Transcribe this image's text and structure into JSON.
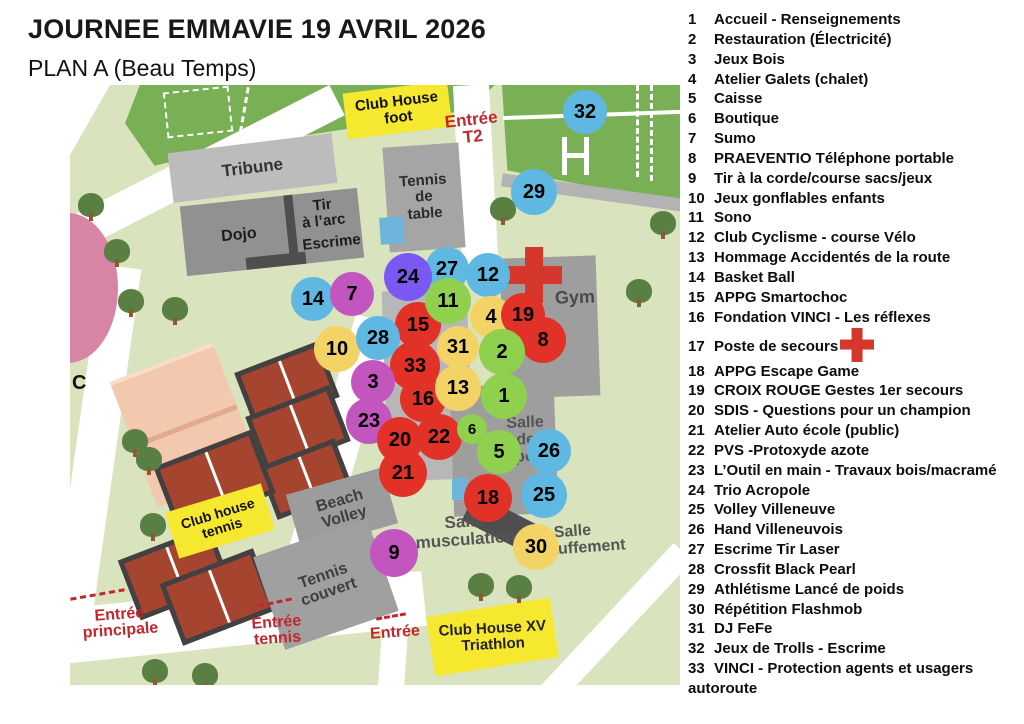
{
  "title": "JOURNEE EMMAVIE 19 AVRIL 2026",
  "subtitle": "PLAN A (Beau Temps)",
  "legend": {
    "items": [
      {
        "num": "1",
        "label": "Accueil - Renseignements"
      },
      {
        "num": "2",
        "label": "Restauration (Électricité)"
      },
      {
        "num": "3",
        "label": "Jeux Bois"
      },
      {
        "num": "4",
        "label": "Atelier Galets (chalet)"
      },
      {
        "num": "5",
        "label": "Caisse"
      },
      {
        "num": "6",
        "label": "Boutique"
      },
      {
        "num": "7",
        "label": "Sumo"
      },
      {
        "num": "8",
        "label": "PRAEVENTIO Téléphone portable"
      },
      {
        "num": "9",
        "label": "Tir à la corde/course sacs/jeux"
      },
      {
        "num": "10",
        "label": "Jeux gonflables enfants"
      },
      {
        "num": "11",
        "label": "Sono"
      },
      {
        "num": "12",
        "label": "Club Cyclisme  - course Vélo"
      },
      {
        "num": "13",
        "label": "Hommage Accidentés de la route"
      },
      {
        "num": "14",
        "label": "Basket Ball"
      },
      {
        "num": "15",
        "label": "APPG Smartochoc"
      },
      {
        "num": "16",
        "label": "Fondation  VINCI - Les réflexes"
      },
      {
        "num": "17",
        "label": "Poste de secours",
        "cross": true
      },
      {
        "num": "18",
        "label": "APPG Escape Game"
      },
      {
        "num": "19",
        "label": "CROIX ROUGE Gestes 1er secours"
      },
      {
        "num": "20",
        "label": "SDIS - Questions pour un champion"
      },
      {
        "num": "21",
        "label": "Atelier Auto école (public)"
      },
      {
        "num": "22",
        "label": "PVS -Protoxyde azote"
      },
      {
        "num": "23",
        "label": "L’Outil en main - Travaux bois/macramé"
      },
      {
        "num": "24",
        "label": "Trio Acropole"
      },
      {
        "num": "25",
        "label": "Volley Villeneuve"
      },
      {
        "num": "26",
        "label": "Hand Villeneuvois"
      },
      {
        "num": "27",
        "label": "Escrime  Tir Laser"
      },
      {
        "num": "28",
        "label": "Crossfit Black Pearl"
      },
      {
        "num": "29",
        "label": "Athlétisme Lancé de poids"
      },
      {
        "num": "30",
        "label": "Répétition Flashmob"
      },
      {
        "num": "31",
        "label": "DJ FeFe"
      },
      {
        "num": "32",
        "label": "Jeux de Trolls - Escrime"
      },
      {
        "num": "33",
        "label": "VINCI - Protection agents et usagers autoroute"
      }
    ]
  },
  "map": {
    "labels": {
      "tribune": "Tribune",
      "club_house_foot": "Club House\nfoot",
      "tennis_de_table": "Tennis\nde\ntable",
      "dojo": "Dojo",
      "tir_a_larc": "Tir\nà l’arc",
      "escrime": "Escrime",
      "gym": "Gym",
      "salle_de_sport": "Salle\nde sport",
      "salle_musculation": "Salle\nmusculation",
      "salle_echauffement": "Salle\néchauffement",
      "beach_volley": "Beach\nVolley",
      "tennis_couvert": "Tennis\ncouvert",
      "club_house_tennis": "Club house\ntennis",
      "club_house_xv": "Club House XV\nTriathlon",
      "c_label": "C"
    },
    "entrances": {
      "t2": "Entrée\nT2",
      "principale": "Entrée\nprincipale",
      "tennis": "Entrée\ntennis",
      "simple": "Entrée"
    },
    "marker_colors": {
      "blue": "#5fb8e2",
      "red": "#e23127",
      "green": "#8fd04e",
      "yellow": "#f4d366",
      "magenta": "#c355be",
      "purple": "#7a58f2"
    },
    "markers": [
      {
        "num": "32",
        "color": "blue",
        "x": 515,
        "y": 27,
        "r": 22
      },
      {
        "num": "29",
        "color": "blue",
        "x": 464,
        "y": 107,
        "r": 23
      },
      {
        "num": "14",
        "color": "blue",
        "x": 243,
        "y": 214,
        "r": 22
      },
      {
        "num": "7",
        "color": "magenta",
        "x": 282,
        "y": 209,
        "r": 22
      },
      {
        "num": "27",
        "color": "blue",
        "x": 377,
        "y": 184,
        "r": 22
      },
      {
        "num": "24",
        "color": "purple",
        "x": 338,
        "y": 192,
        "r": 24
      },
      {
        "num": "12",
        "color": "blue",
        "x": 418,
        "y": 190,
        "r": 22
      },
      {
        "num": "15",
        "color": "red",
        "x": 348,
        "y": 240,
        "r": 23
      },
      {
        "num": "11",
        "color": "green",
        "x": 378,
        "y": 216,
        "r": 23
      },
      {
        "num": "4",
        "color": "yellow",
        "x": 421,
        "y": 232,
        "r": 21
      },
      {
        "num": "8",
        "color": "red",
        "x": 473,
        "y": 255,
        "r": 23
      },
      {
        "num": "19",
        "color": "red",
        "x": 453,
        "y": 230,
        "r": 22
      },
      {
        "num": "10",
        "color": "yellow",
        "x": 267,
        "y": 264,
        "r": 23
      },
      {
        "num": "28",
        "color": "blue",
        "x": 308,
        "y": 253,
        "r": 22
      },
      {
        "num": "31",
        "color": "yellow",
        "x": 388,
        "y": 262,
        "r": 21
      },
      {
        "num": "2",
        "color": "green",
        "x": 432,
        "y": 267,
        "r": 23
      },
      {
        "num": "33",
        "color": "red",
        "x": 345,
        "y": 281,
        "r": 25
      },
      {
        "num": "3",
        "color": "magenta",
        "x": 303,
        "y": 297,
        "r": 22
      },
      {
        "num": "16",
        "color": "red",
        "x": 353,
        "y": 314,
        "r": 23
      },
      {
        "num": "13",
        "color": "yellow",
        "x": 388,
        "y": 303,
        "r": 23
      },
      {
        "num": "1",
        "color": "green",
        "x": 434,
        "y": 311,
        "r": 23
      },
      {
        "num": "23",
        "color": "magenta",
        "x": 299,
        "y": 336,
        "r": 23
      },
      {
        "num": "20",
        "color": "red",
        "x": 330,
        "y": 355,
        "r": 23
      },
      {
        "num": "22",
        "color": "red",
        "x": 369,
        "y": 352,
        "r": 23
      },
      {
        "num": "6",
        "color": "green",
        "x": 402,
        "y": 344,
        "r": 15
      },
      {
        "num": "5",
        "color": "green",
        "x": 429,
        "y": 367,
        "r": 22
      },
      {
        "num": "21",
        "color": "red",
        "x": 333,
        "y": 388,
        "r": 24
      },
      {
        "num": "26",
        "color": "blue",
        "x": 479,
        "y": 366,
        "r": 22
      },
      {
        "num": "25",
        "color": "blue",
        "x": 474,
        "y": 410,
        "r": 23
      },
      {
        "num": "18",
        "color": "red",
        "x": 418,
        "y": 413,
        "r": 24
      },
      {
        "num": "30",
        "color": "yellow",
        "x": 466,
        "y": 462,
        "r": 23
      },
      {
        "num": "9",
        "color": "magenta",
        "x": 324,
        "y": 468,
        "r": 24
      }
    ]
  }
}
